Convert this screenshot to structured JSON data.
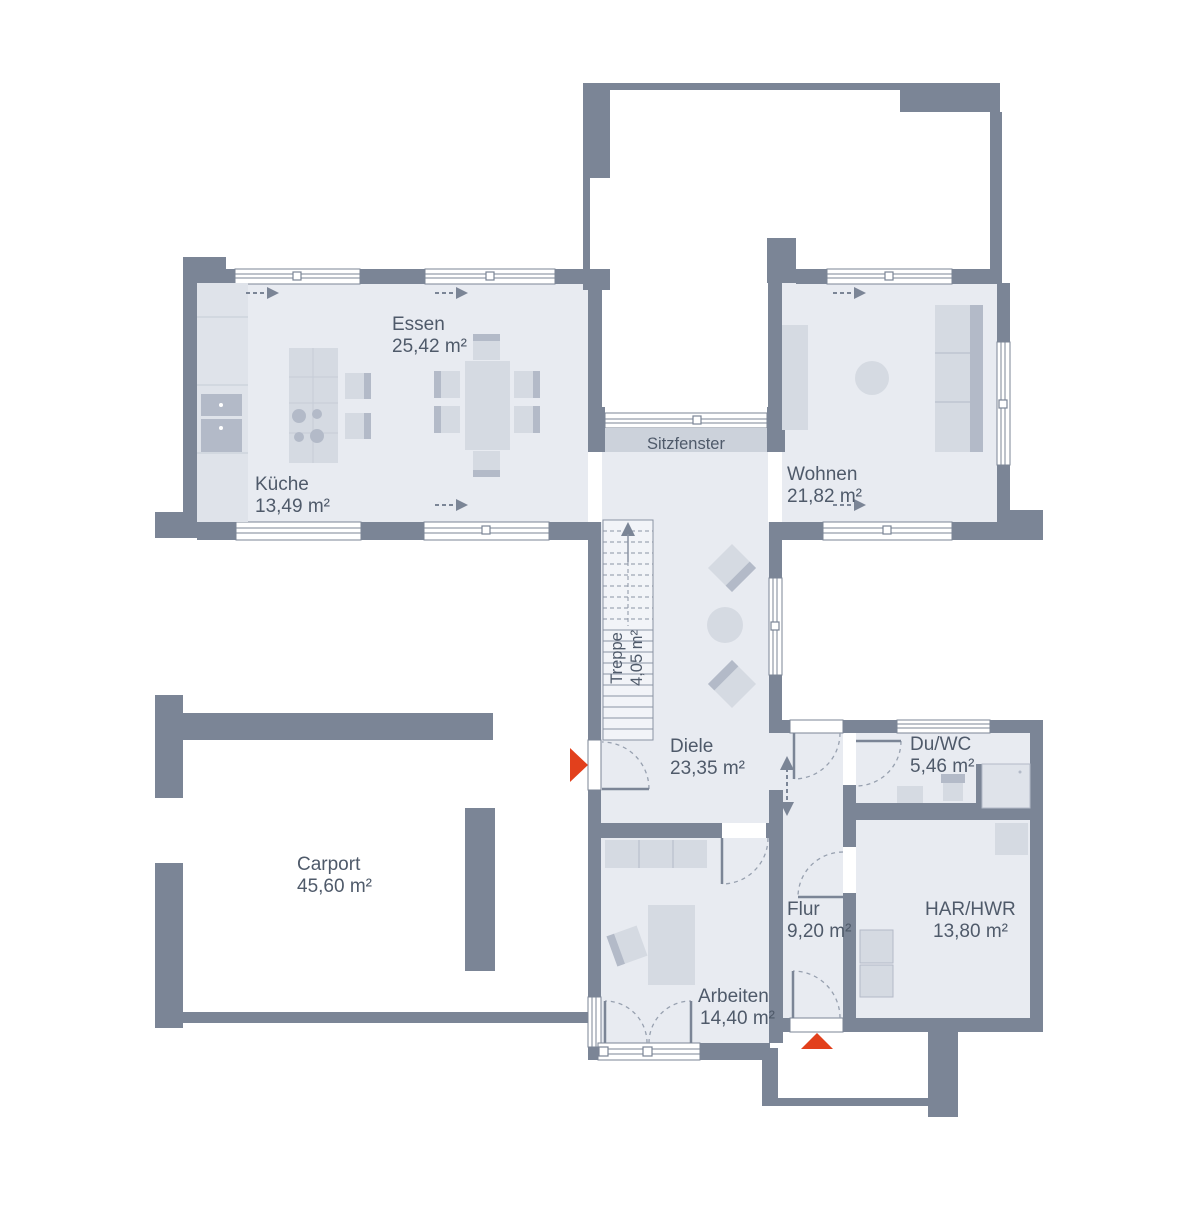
{
  "plan": {
    "kind": "floor-plan"
  },
  "colors": {
    "wall": "#7b8596",
    "room_fill": "#e8ebf1",
    "furniture": "#d5dae2",
    "furniture_dark": "#b3bac8",
    "furniture_light": "#dfe3ea",
    "seat_fill": "#ccd2db",
    "stair_fill": "#f2f4f8",
    "line": "#8a93a3",
    "grid_line": "#c6ccd7",
    "door_arc": "#97a0af",
    "text": "#4f5a6a",
    "accent_red": "#e2401c",
    "background": "#ffffff"
  },
  "rooms": [
    {
      "id": "essen",
      "name": "Essen",
      "area": "25,42 m²"
    },
    {
      "id": "kueche",
      "name": "Küche",
      "area": "13,49 m²"
    },
    {
      "id": "wohnen",
      "name": "Wohnen",
      "area": "21,82 m²"
    },
    {
      "id": "treppe",
      "name": "Treppe",
      "area": "4,05 m²"
    },
    {
      "id": "diele",
      "name": "Diele",
      "area": "23,35 m²"
    },
    {
      "id": "duwc",
      "name": "Du/WC",
      "area": "5,46 m²"
    },
    {
      "id": "carport",
      "name": "Carport",
      "area": "45,60 m²"
    },
    {
      "id": "flur",
      "name": "Flur",
      "area": "9,20 m²"
    },
    {
      "id": "harhwr",
      "name": "HAR/HWR",
      "area": "13,80 m²"
    },
    {
      "id": "arbeiten",
      "name": "Arbeiten",
      "area": "14,40 m²"
    }
  ],
  "features": {
    "sitzfenster_label": "Sitzfenster"
  },
  "markers": {
    "side_entrance_direction": "right",
    "main_entrance_direction": "up"
  }
}
